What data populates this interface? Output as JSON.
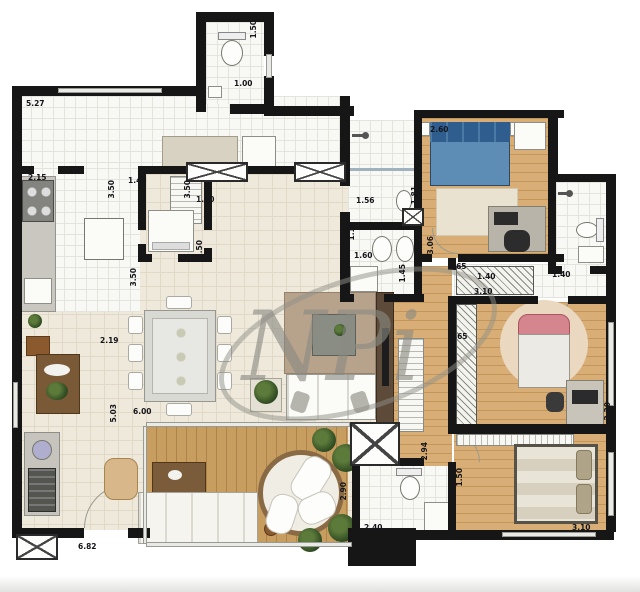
{
  "watermark": {
    "text": "NPi"
  },
  "labels": [
    {
      "text": "5.27",
      "x": 26,
      "y": 100
    },
    {
      "text": "1.70",
      "x": 13,
      "y": 142,
      "o": "v"
    },
    {
      "text": "1.50",
      "x": 250,
      "y": 20,
      "o": "v"
    },
    {
      "text": "1.00",
      "x": 234,
      "y": 80
    },
    {
      "text": "2.15",
      "x": 28,
      "y": 174
    },
    {
      "text": "3.50",
      "x": 108,
      "y": 180,
      "o": "v"
    },
    {
      "text": "1.40",
      "x": 128,
      "y": 177
    },
    {
      "text": "3.50",
      "x": 184,
      "y": 180,
      "o": "v"
    },
    {
      "text": "1.50",
      "x": 196,
      "y": 196
    },
    {
      "text": "1.50",
      "x": 196,
      "y": 240,
      "o": "v"
    },
    {
      "text": "3.50",
      "x": 130,
      "y": 268,
      "o": "v"
    },
    {
      "text": "2.19",
      "x": 100,
      "y": 337
    },
    {
      "text": "6.00",
      "x": 133,
      "y": 408
    },
    {
      "text": "5.03",
      "x": 110,
      "y": 404,
      "o": "v"
    },
    {
      "text": "6.82",
      "x": 78,
      "y": 543
    },
    {
      "text": "1.56",
      "x": 356,
      "y": 197
    },
    {
      "text": "1.81",
      "x": 411,
      "y": 186,
      "o": "v"
    },
    {
      "text": "1.10",
      "x": 348,
      "y": 222,
      "o": "v"
    },
    {
      "text": "1.60",
      "x": 354,
      "y": 252
    },
    {
      "text": "1.45",
      "x": 399,
      "y": 264,
      "o": "v"
    },
    {
      "text": "3.06",
      "x": 427,
      "y": 236,
      "o": "v"
    },
    {
      "text": "2.60",
      "x": 430,
      "y": 126
    },
    {
      "text": "2.20",
      "x": 550,
      "y": 186,
      "o": "v"
    },
    {
      "text": "1.40",
      "x": 552,
      "y": 271
    },
    {
      "text": "1.65",
      "x": 448,
      "y": 263
    },
    {
      "text": "1.40",
      "x": 477,
      "y": 273
    },
    {
      "text": "3.10",
      "x": 474,
      "y": 288
    },
    {
      "text": "1.65",
      "x": 449,
      "y": 333
    },
    {
      "text": "2.90",
      "x": 340,
      "y": 482,
      "o": "v"
    },
    {
      "text": "2.40",
      "x": 364,
      "y": 524
    },
    {
      "text": "2.94",
      "x": 421,
      "y": 442,
      "o": "v"
    },
    {
      "text": "1.50",
      "x": 456,
      "y": 468,
      "o": "v"
    },
    {
      "text": "3.10",
      "x": 572,
      "y": 524
    },
    {
      "text": "2.20",
      "x": 604,
      "y": 402,
      "o": "v"
    }
  ],
  "colors": {
    "wall": "#161616",
    "wood_floor": "#d8ae76",
    "deck_floor": "#c79e60",
    "tile_floor": "#f8f8f5",
    "beige_floor": "#efe9dc",
    "bed_blue": "#5d8cb4",
    "bed_pink": "#d4858e",
    "watermark_gray": "#8e8e86"
  }
}
